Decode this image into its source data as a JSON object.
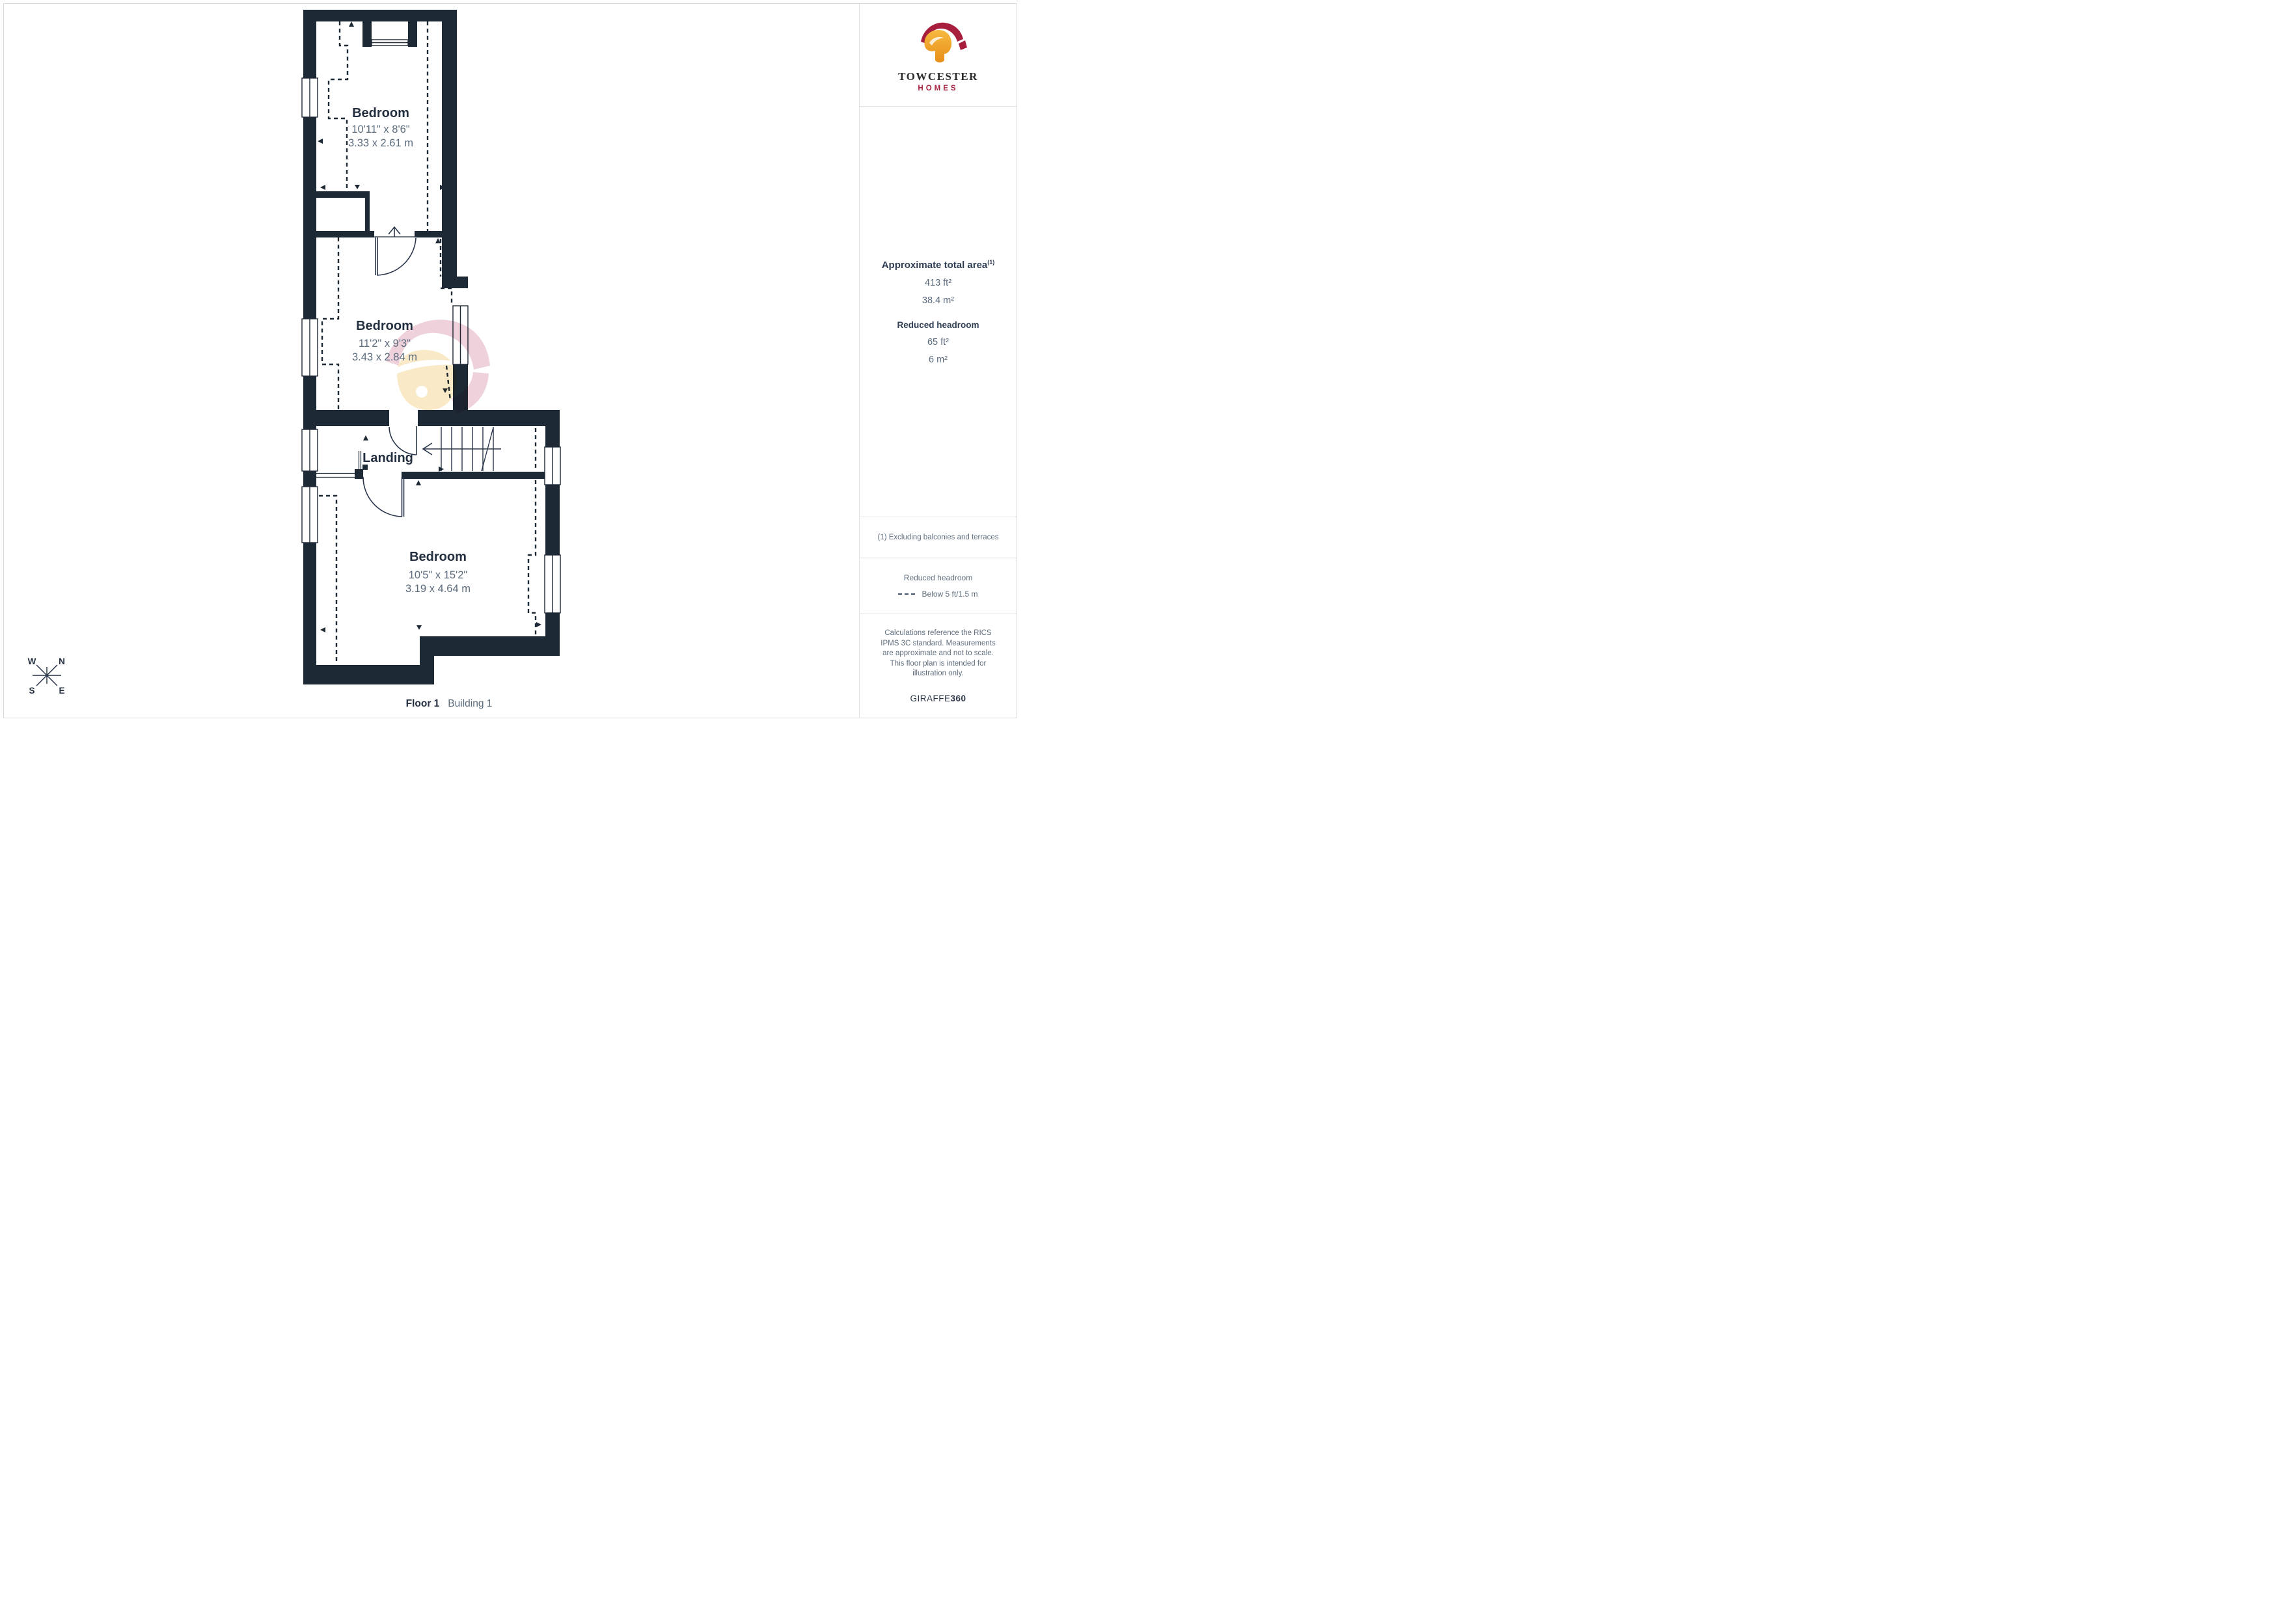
{
  "plan": {
    "rooms": [
      {
        "name": "Bedroom",
        "imperial": "10'11\" x 8'6\"",
        "metric": "3.33 x 2.61 m"
      },
      {
        "name": "Bedroom",
        "imperial": "11'2\" x 9'3\"",
        "metric": "3.43 x 2.84 m"
      },
      {
        "name": "Landing"
      },
      {
        "name": "Bedroom",
        "imperial": "10'5\" x 15'2\"",
        "metric": "3.19 x 4.64 m"
      }
    ],
    "floor_label": "Floor 1",
    "building_label": "Building 1",
    "compass": {
      "n": "N",
      "e": "E",
      "s": "S",
      "w": "W"
    }
  },
  "sidebar": {
    "brand": {
      "name": "TOWCESTER",
      "sub": "HOMES"
    },
    "area": {
      "title": "Approximate total area",
      "superscript": "(1)",
      "imperial": "413 ft²",
      "metric": "38.4 m²",
      "reduced_title": "Reduced headroom",
      "reduced_imperial": "65 ft²",
      "reduced_metric": "6 m²"
    },
    "footnote": "(1) Excluding balconies and terraces",
    "legend": {
      "title": "Reduced headroom",
      "item": "Below 5 ft/1.5 m"
    },
    "disclaimer": "Calculations reference the RICS IPMS 3C standard. Measurements are approximate and not to scale. This floor plan is intended for illustration only.",
    "credit": {
      "brand": "GIRAFFE",
      "suffix": "360"
    }
  },
  "colors": {
    "wall": "#1e2936",
    "text_dark": "#243040",
    "text_gray": "#5b6b7c",
    "crimson": "#a81e3d",
    "gold": "#f0a02f",
    "watermark_pink": "#d990ab",
    "watermark_yellow": "#f3c979"
  }
}
